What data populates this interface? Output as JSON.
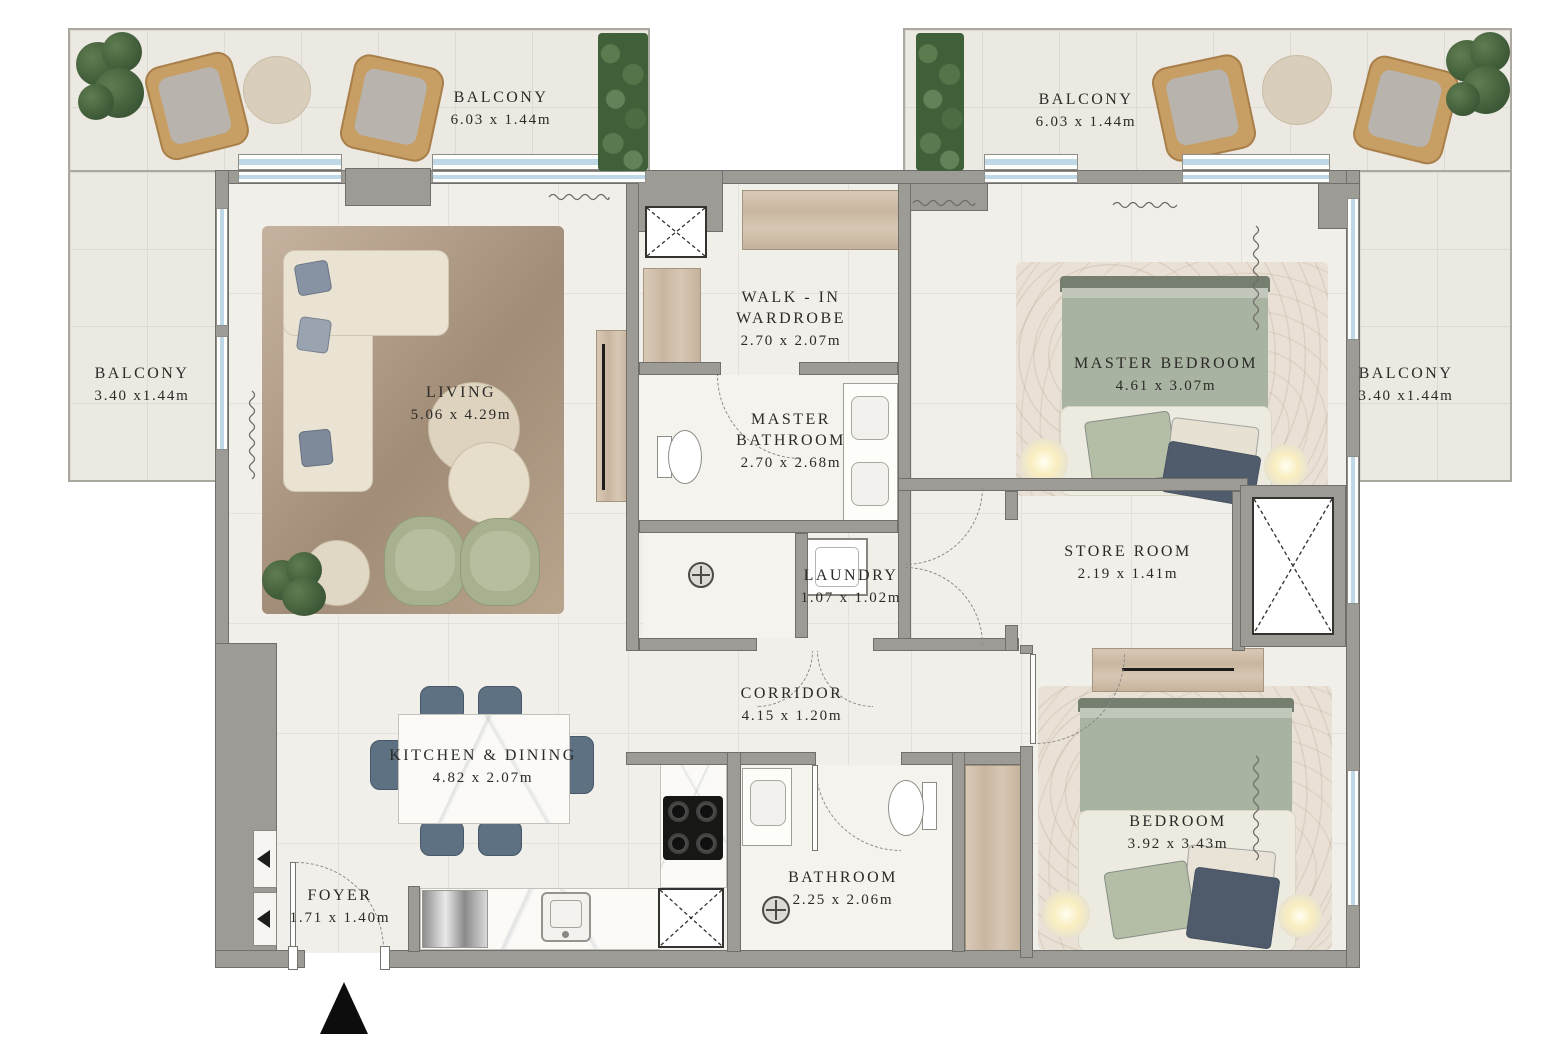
{
  "rooms": {
    "living": {
      "name": "LIVING",
      "dims": "5.06 x 4.29m"
    },
    "kitchen_dining": {
      "name": "KITCHEN & DINING",
      "dims": "4.82 x 2.07m"
    },
    "foyer": {
      "name": "FOYER",
      "dims": "1.71 x 1.40m"
    },
    "walk_in_wardrobe": {
      "name": "WALK - IN WARDROBE",
      "dims": "2.70 x 2.07m"
    },
    "master_bathroom": {
      "name": "MASTER BATHROOM",
      "dims": "2.70 x 2.68m"
    },
    "master_bedroom": {
      "name": "MASTER BEDROOM",
      "dims": "4.61 x 3.07m"
    },
    "laundry": {
      "name": "LAUNDRY",
      "dims": "1.07 x 1.02m"
    },
    "store_room": {
      "name": "STORE ROOM",
      "dims": "2.19 x 1.41m"
    },
    "corridor": {
      "name": "CORRIDOR",
      "dims": "4.15 x 1.20m"
    },
    "bedroom": {
      "name": "BEDROOM",
      "dims": "3.92 x 3.43m"
    },
    "bathroom": {
      "name": "BATHROOM",
      "dims": "2.25 x 2.06m"
    }
  },
  "balconies": {
    "top_left": {
      "name": "BALCONY",
      "dims": "6.03 x 1.44m"
    },
    "top_right": {
      "name": "BALCONY",
      "dims": "6.03 x 1.44m"
    },
    "left": {
      "name": "BALCONY",
      "dims": "3.40 x1.44m"
    },
    "right": {
      "name": "BALCONY",
      "dims": "3.40 x1.44m"
    }
  },
  "colors": {
    "wall": "#9d9b96",
    "floor": "#f1efe9",
    "balcony_floor": "#ebe9e1",
    "window_glass": "#bed8e7",
    "wood": "#d2c2af",
    "plant_green": "#4c6a41",
    "sofa_beige": "#eae3d4",
    "dining_chair_blue": "#5d7183",
    "armchair_green": "#a7b190",
    "bed_blanket_sage": "#a9b3a1",
    "label_text": "#2c2a27",
    "entrance_marker": "#0d0d0d"
  }
}
